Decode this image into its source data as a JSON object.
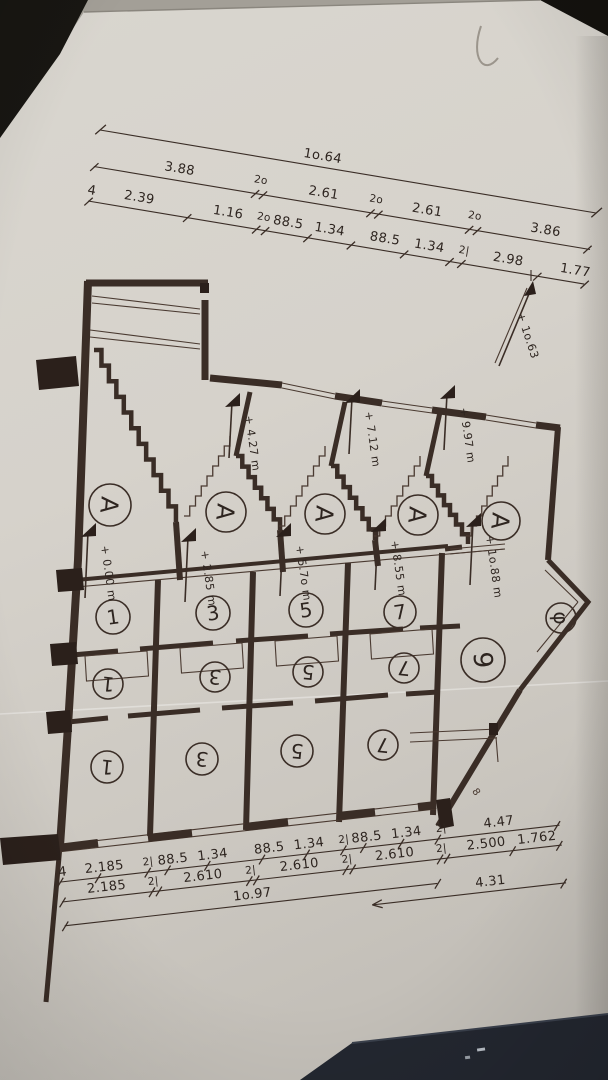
{
  "scene": {
    "paper_color": "#d8d4cd",
    "ink_color": "#3a2d26",
    "background_color": "#17150f",
    "object_color": "#232730"
  },
  "dims_top": {
    "overall": [
      "1o.64"
    ],
    "row2": [
      "3.88",
      "2o",
      "2.61",
      "2o",
      "2.61",
      "2o",
      "3.86"
    ],
    "row3": [
      "4",
      "2.39",
      "1.16",
      "2o",
      "88.5",
      "1.34",
      "88.5",
      "1.34",
      "2|",
      "2.98",
      "1.77"
    ]
  },
  "dims_bottom": {
    "row1": [
      "4",
      "2.185",
      "2|",
      "88.5",
      "1.34",
      "88.5",
      "1.34",
      "2|",
      "88.5",
      "1.34",
      "2|",
      "4.47"
    ],
    "row2": [
      "2.185",
      "2|",
      "2.610",
      "2|",
      "2.610",
      "2|",
      "2.610",
      "2|",
      "2.500",
      "1.762"
    ],
    "row3": [
      "1o.97",
      "4.31"
    ]
  },
  "levels": {
    "upper": [
      "+ 4.27 m",
      "+ 7.12 m",
      "+ 9.97 m"
    ],
    "lower": [
      "+ 0.00 m",
      "+ 2.85 m",
      "+ 5.7o m",
      "+ 8.55 m",
      "+ 1o.88 m"
    ],
    "site": "+ 1o.63"
  },
  "unit_labels": {
    "letter": "A",
    "row1": [
      "1",
      "3",
      "5",
      "7"
    ],
    "row2": [
      "1",
      "3",
      "5",
      "7"
    ],
    "row3": [
      "1",
      "3",
      "5",
      "7"
    ],
    "big_room": "9",
    "end_room": "φ",
    "note": "8"
  }
}
